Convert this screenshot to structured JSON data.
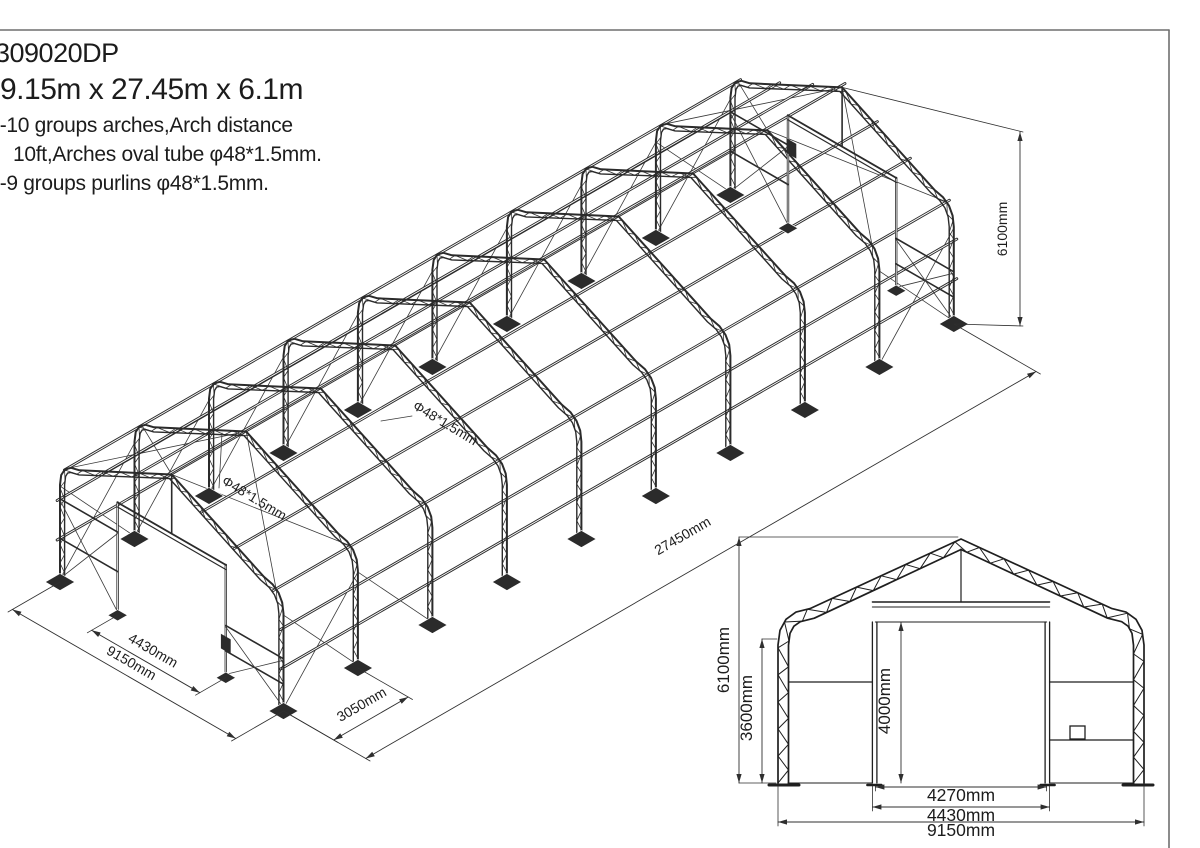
{
  "title": {
    "model": "309020DP",
    "size": "9.15m x 27.45m x 6.1m",
    "note1": "--10 groups arches,Arch distance",
    "note2": "10ft,Arches oval tube  φ48*1.5mm.",
    "note3": "--9 groups purlins  φ48*1.5mm."
  },
  "iso": {
    "dim_width": "9150mm",
    "dim_door_frame": "4430mm",
    "dim_bay_spacing": "3050mm",
    "dim_length": "27450mm",
    "dim_height": "6100mm",
    "tube_label_arch": "Φ48*1.5mm",
    "tube_label_purlin": "Φ48*1.5mm"
  },
  "elevation": {
    "dim_height": "6100mm",
    "dim_eave_height": "3600mm",
    "dim_door_height": "4000mm",
    "dim_door_clear": "4270mm",
    "dim_door_frame": "4430mm",
    "dim_width": "9150mm"
  },
  "colors": {
    "line": "#2b2b2b",
    "thin": "#3a3a3a",
    "dim": "#2f2f2f",
    "border": "#6f6f6f",
    "background": "#ffffff"
  }
}
